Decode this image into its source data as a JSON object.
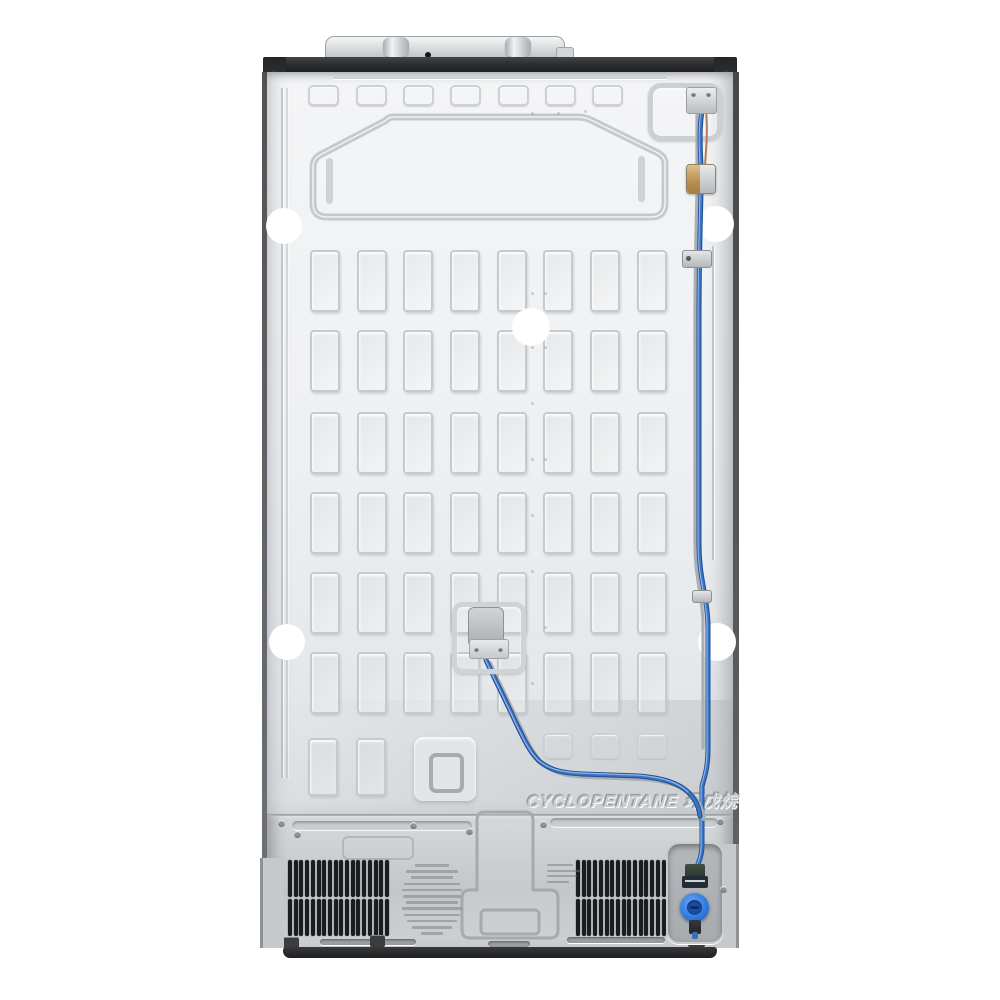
{
  "scene": {
    "description": "rear view of a refrigerator back panel",
    "background": "#ffffff",
    "embossed_label": "CYCLOPENTANE 环戊烷",
    "colors": {
      "panel": "#eef0f2",
      "panel_edge": "#d9dcde",
      "bottom_panel": "#c9cccf",
      "dark_trim": "#2b2c2e",
      "groove": "#c3c7ca",
      "tube_blue": "#2e63ae",
      "tube_blue_dark": "#1f4e92",
      "tube_gray": "#abafb3",
      "brass_fitting": "#c89f63",
      "valve_blue": "#2f7ce0",
      "valve_body": "#232d36",
      "vent_slat": "#1b1c1e",
      "base": "#232426"
    }
  },
  "grid": {
    "columns_x": [
      310,
      357,
      403,
      450,
      497,
      543,
      590,
      637
    ],
    "rows_y": [
      250,
      330,
      412,
      492,
      572,
      652
    ],
    "rect_w": 26,
    "rect_h": 58,
    "top_row": {
      "y": 85,
      "h": 17,
      "w": 27,
      "columns_x": [
        308,
        356,
        403,
        450,
        498,
        545,
        592
      ]
    },
    "bottom_row": {
      "tall": {
        "y": 738,
        "h": 54,
        "columns_x": [
          308,
          356
        ]
      },
      "short": {
        "y": 733,
        "h": 22,
        "columns_x": [
          543,
          590,
          637
        ]
      }
    }
  },
  "white_dots": [
    {
      "x": 284,
      "y": 226,
      "r": 18
    },
    {
      "x": 716,
      "y": 224,
      "r": 18
    },
    {
      "x": 531,
      "y": 327,
      "r": 19
    },
    {
      "x": 287,
      "y": 642,
      "r": 18
    },
    {
      "x": 717,
      "y": 642,
      "r": 19
    }
  ],
  "texture_dots": [
    {
      "x": 531,
      "y": 112
    },
    {
      "x": 557,
      "y": 112
    },
    {
      "x": 584,
      "y": 110
    },
    {
      "x": 531,
      "y": 292
    },
    {
      "x": 544,
      "y": 292
    },
    {
      "x": 531,
      "y": 346
    },
    {
      "x": 544,
      "y": 346
    },
    {
      "x": 531,
      "y": 402
    },
    {
      "x": 531,
      "y": 458
    },
    {
      "x": 544,
      "y": 458
    },
    {
      "x": 531,
      "y": 514
    },
    {
      "x": 531,
      "y": 570
    },
    {
      "x": 544,
      "y": 626
    },
    {
      "x": 531,
      "y": 682
    }
  ],
  "grilles": {
    "left": {
      "x": 288,
      "rows_y": [
        860,
        899
      ],
      "row_h": 37,
      "slat_w": 4,
      "pitch": 5.7,
      "count": 18
    },
    "right": {
      "x": 576,
      "rows_y": [
        860,
        899
      ],
      "row_h": 37,
      "slat_w": 4,
      "pitch": 5.7,
      "count": 16
    }
  },
  "spec_label_lines": {
    "x": 402,
    "y": 864,
    "step": 6.2,
    "h": 2.6,
    "widths": [
      34,
      52,
      42,
      56,
      60,
      58,
      52,
      60,
      56,
      50,
      40,
      22
    ]
  },
  "mini_label_lines": {
    "x": 547,
    "y": 864,
    "step": 5.5,
    "h": 2.4,
    "widths": [
      26,
      34,
      30,
      22
    ]
  }
}
